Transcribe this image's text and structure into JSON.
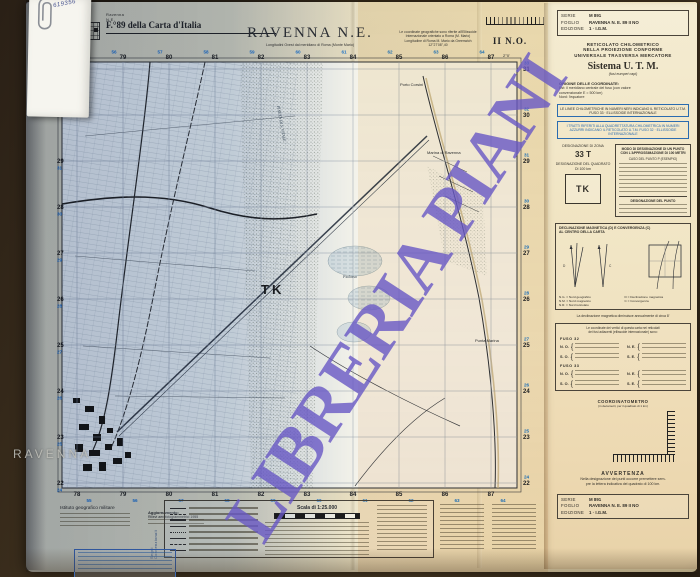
{
  "note_card": {
    "number": "619356"
  },
  "header": {
    "corner_label": "Ravenna N.E.",
    "sheet_ref": "F.°89 della Carta d'Italia",
    "title": "RAVENNA N.E.",
    "subtitle": "Longitudini Ovest dal meridiano di Roma (Monte Mario)",
    "quadrant": "II N.O.",
    "geo_note_1": "Le coordinate geografiche sono riferite all'Ellissoide",
    "geo_note_2": "Internazionale orientato a Roma (M. Mario)",
    "geo_note_3": "Longitudine di Roma M. Mario da Greenwich 12°27'08\",40"
  },
  "watermark": {
    "text": "LIBRERIA PIANI",
    "color": "#6858c4"
  },
  "map": {
    "square_label": "TK",
    "city_label": "RAVENNA",
    "eastings": [
      "78",
      "79",
      "80",
      "81",
      "82",
      "83",
      "84",
      "85",
      "86",
      "87"
    ],
    "eastings_blue": [
      "55",
      "56",
      "57",
      "58",
      "59",
      "60",
      "61",
      "62",
      "63",
      "64"
    ],
    "northings": [
      "31",
      "30",
      "29",
      "28",
      "27",
      "26",
      "25",
      "24",
      "23",
      "22"
    ],
    "northings_blue": [
      "33",
      "32",
      "31",
      "30",
      "29",
      "28",
      "27",
      "26",
      "25",
      "24"
    ],
    "labels": {
      "porto_corsini": "Porto Corsini",
      "marina_di_ravenna": "Marina di Ravenna",
      "punta_marina": "Punta Marina",
      "pialassa": "Pialassa",
      "pineta": "PINETA DI S. VITALE",
      "corner_lon": "2°0'"
    }
  },
  "panel": {
    "info_box": {
      "serie_label": "SERIE",
      "serie_value": "M 891",
      "foglio_label": "FOGLIO",
      "foglio_value": "RAVENNA N. E. 89 II NO",
      "edizione_label": "EDIZIONE",
      "edizione_value": "1 · I.G.M."
    },
    "reticolato_1": "RETICOLATO CHILOMETRICO",
    "reticolato_2": "NELLA PROIEZIONE CONFORME",
    "reticolato_3": "UNIVERSALE TRASVERSA MERCATORE",
    "utm_title": "Sistema U. T. M.",
    "utm_sub": "(fusi europei capi)",
    "origine_title": "ORIGINE DELLE COORDINATE:",
    "origine_line1": "Est: il meridiano centrale del fuso (con valore",
    "origine_line2": "convenzionale E = 500 km)",
    "origine_line3": "Nord: l'equatore",
    "note_black": "Le linee chilometriche in numeri neri indicano il reticolato U.T.M. fuso 33 · ellissoide internazionale",
    "note_blue": "I tratti riferiti alla quadrettatura chilometrica in numeri azzurri indicano il reticolato U.T.M. fuso 32 · ellissoide internazionale",
    "zona_title": "DESIGNAZIONE DI ZONA",
    "zona_value": "33 T",
    "quadrato_title": "DESIGNAZIONE DEL QUADRATO DI 100 km",
    "quadrato_value": "TK",
    "modo_title": "MODO DI DESIGNAZIONE DI UN PUNTO CON L'APPROSSIMAZIONE DI 100 METRI",
    "modo_sub": "CASO DEL PUNTO P (ESEMPIO)",
    "designazione_label": "DESIGNAZIONE DEL PUNTO",
    "decl_title_1": "DECLINAZIONE MAGNETICA (D) E CONVERGENZA (C)",
    "decl_title_2": "AL CENTRO DELLA CARTA",
    "decl_legend": [
      "N.G. = Nord geografico",
      "N.M. = Nord magnetico",
      "N.R. = Nord reticolato",
      "D = Declinazione magnetica",
      "C = Convergenza"
    ],
    "decl_note": "La declinazione magnetica diminuisce annualmente di circa 8'",
    "vertici_intro_1": "Le coordinate dei vertici di questa carta nei reticolati",
    "vertici_intro_2": "dei fusi adiacenti (ellissoide internazionale) sono:",
    "fuso_ovest": "FUSO 32",
    "fuso_est": "FUSO 33",
    "corners": [
      "N. O.",
      "N. E.",
      "S. O.",
      "S. E."
    ],
    "coordinatometro": "COORDINATOMETRO",
    "coordinatometro_sub": "(in decametri, per il quadrato di 1 km)",
    "avvertenza_title": "AVVERTENZA",
    "avvertenza_1": "Nella designazione dei punti occorre premettere sem-",
    "avvertenza_2": "pre la lettera indicativa del quadrato di 100 km."
  },
  "legend": {
    "credits": "Istituto geografico militare",
    "aggiornamento_title": "Aggiornamento:",
    "aggiornamento_line": "Rilievi aerofotogrammetrici 1955",
    "scala": "Scala di 1:25.000",
    "segni": "Segni Convenzionali"
  }
}
